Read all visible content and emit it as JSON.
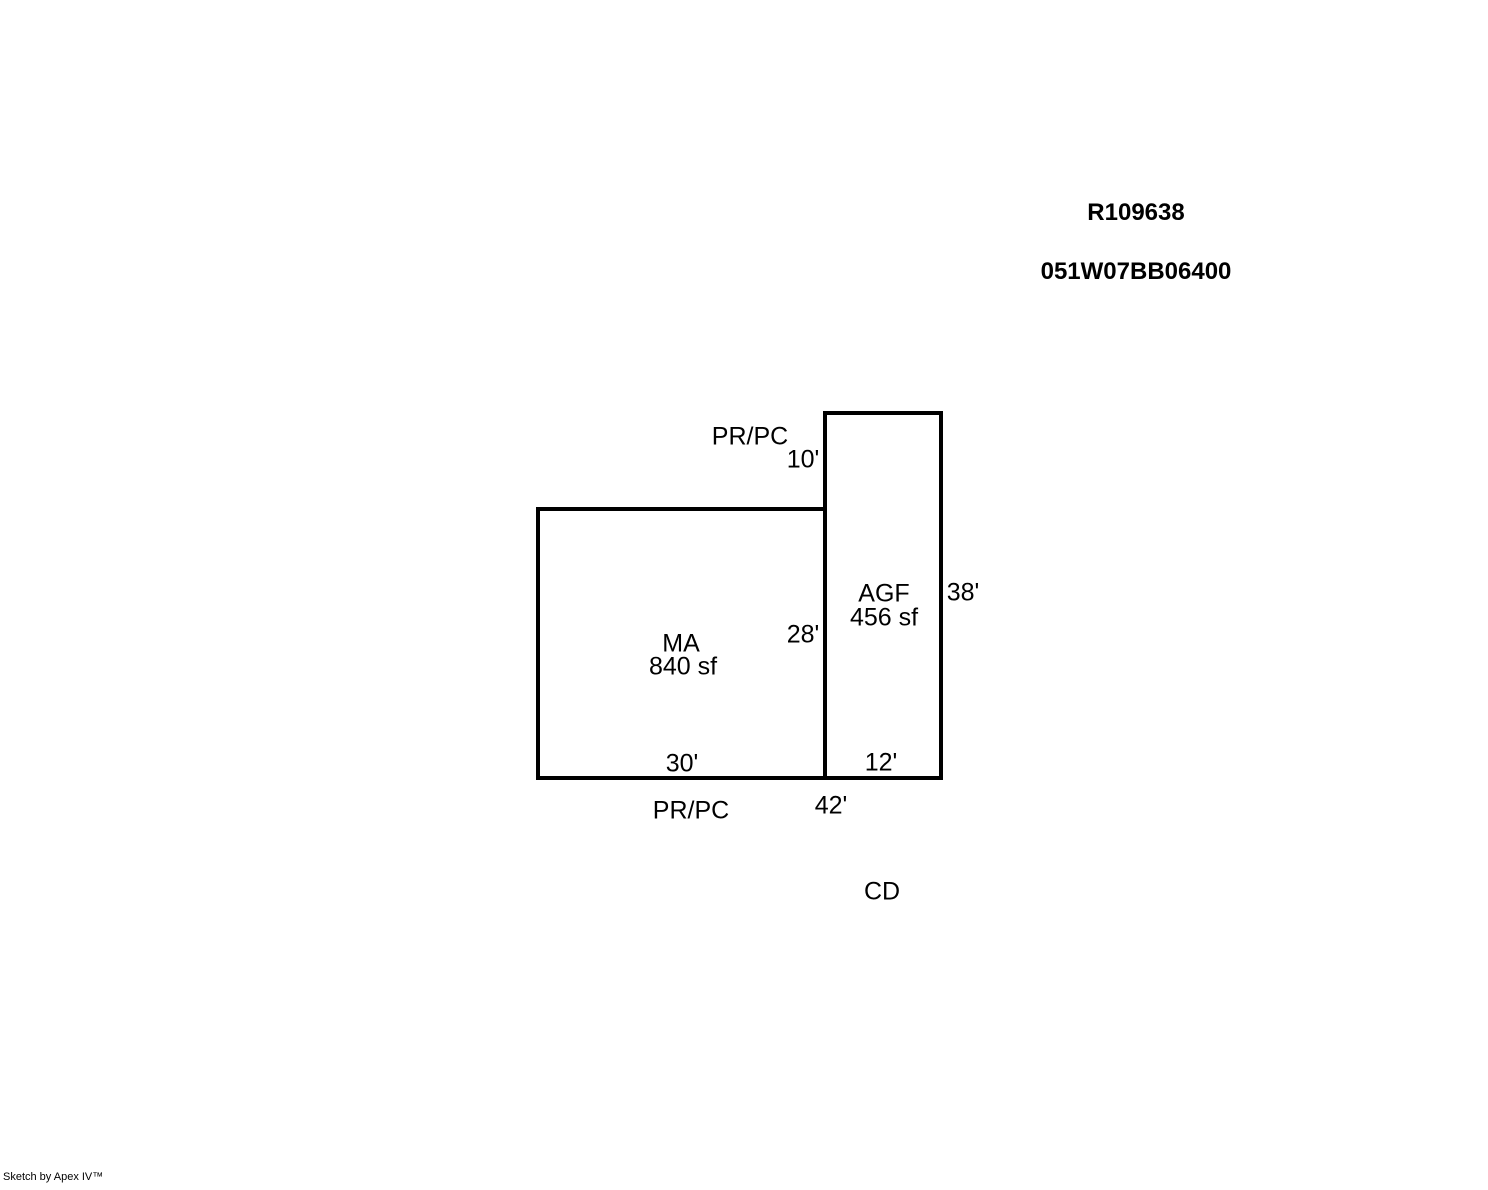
{
  "header": {
    "record_number": "R109638",
    "parcel_number": "051W07BB06400"
  },
  "sketch": {
    "structures": [
      {
        "code": "MA",
        "area": "840 sf",
        "dimensions": {
          "bottom": "30'",
          "right": "28'"
        }
      },
      {
        "code": "AGF",
        "area": "456 sf",
        "dimensions": {
          "top": "10'",
          "right": "38'",
          "bottom": "12'"
        }
      }
    ],
    "annotations": {
      "top_label": "PR/PC",
      "bottom_label": "PR/PC",
      "overall_width": "42'",
      "cd_label": "CD"
    },
    "colors": {
      "line": "#000000",
      "background": "#ffffff"
    }
  },
  "footer": {
    "credit": "Sketch by Apex IV™"
  }
}
